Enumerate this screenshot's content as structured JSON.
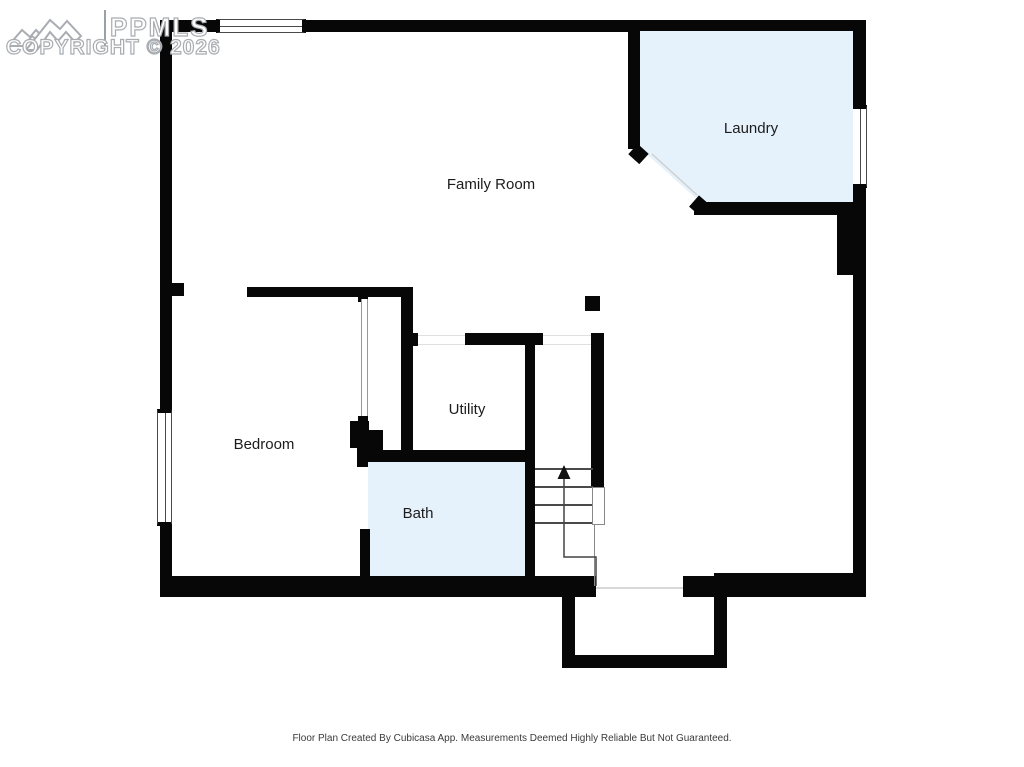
{
  "watermark": {
    "brand": "PPMLS",
    "copyright_line": "COPYRIGHT © 2026"
  },
  "rooms": [
    {
      "name": "family-room",
      "label": "Family Room",
      "shaded": false
    },
    {
      "name": "laundry",
      "label": "Laundry",
      "shaded": true
    },
    {
      "name": "bedroom",
      "label": "Bedroom",
      "shaded": false
    },
    {
      "name": "utility",
      "label": "Utility",
      "shaded": false
    },
    {
      "name": "bath",
      "label": "Bath",
      "shaded": false
    }
  ],
  "stairs": {
    "direction": "up",
    "tread_count": 4
  },
  "footer_caption": "Floor Plan Created By Cubicasa App. Measurements Deemed Highly Reliable But Not Guaranteed.",
  "colors": {
    "wall": "#070707",
    "room_fill": "#e6f2fb",
    "label_text": "#1c1c1c",
    "caption_text": "#3a3a3a",
    "watermark_outline": "#a9adb2",
    "stair_lines": "#4a4a4a"
  }
}
